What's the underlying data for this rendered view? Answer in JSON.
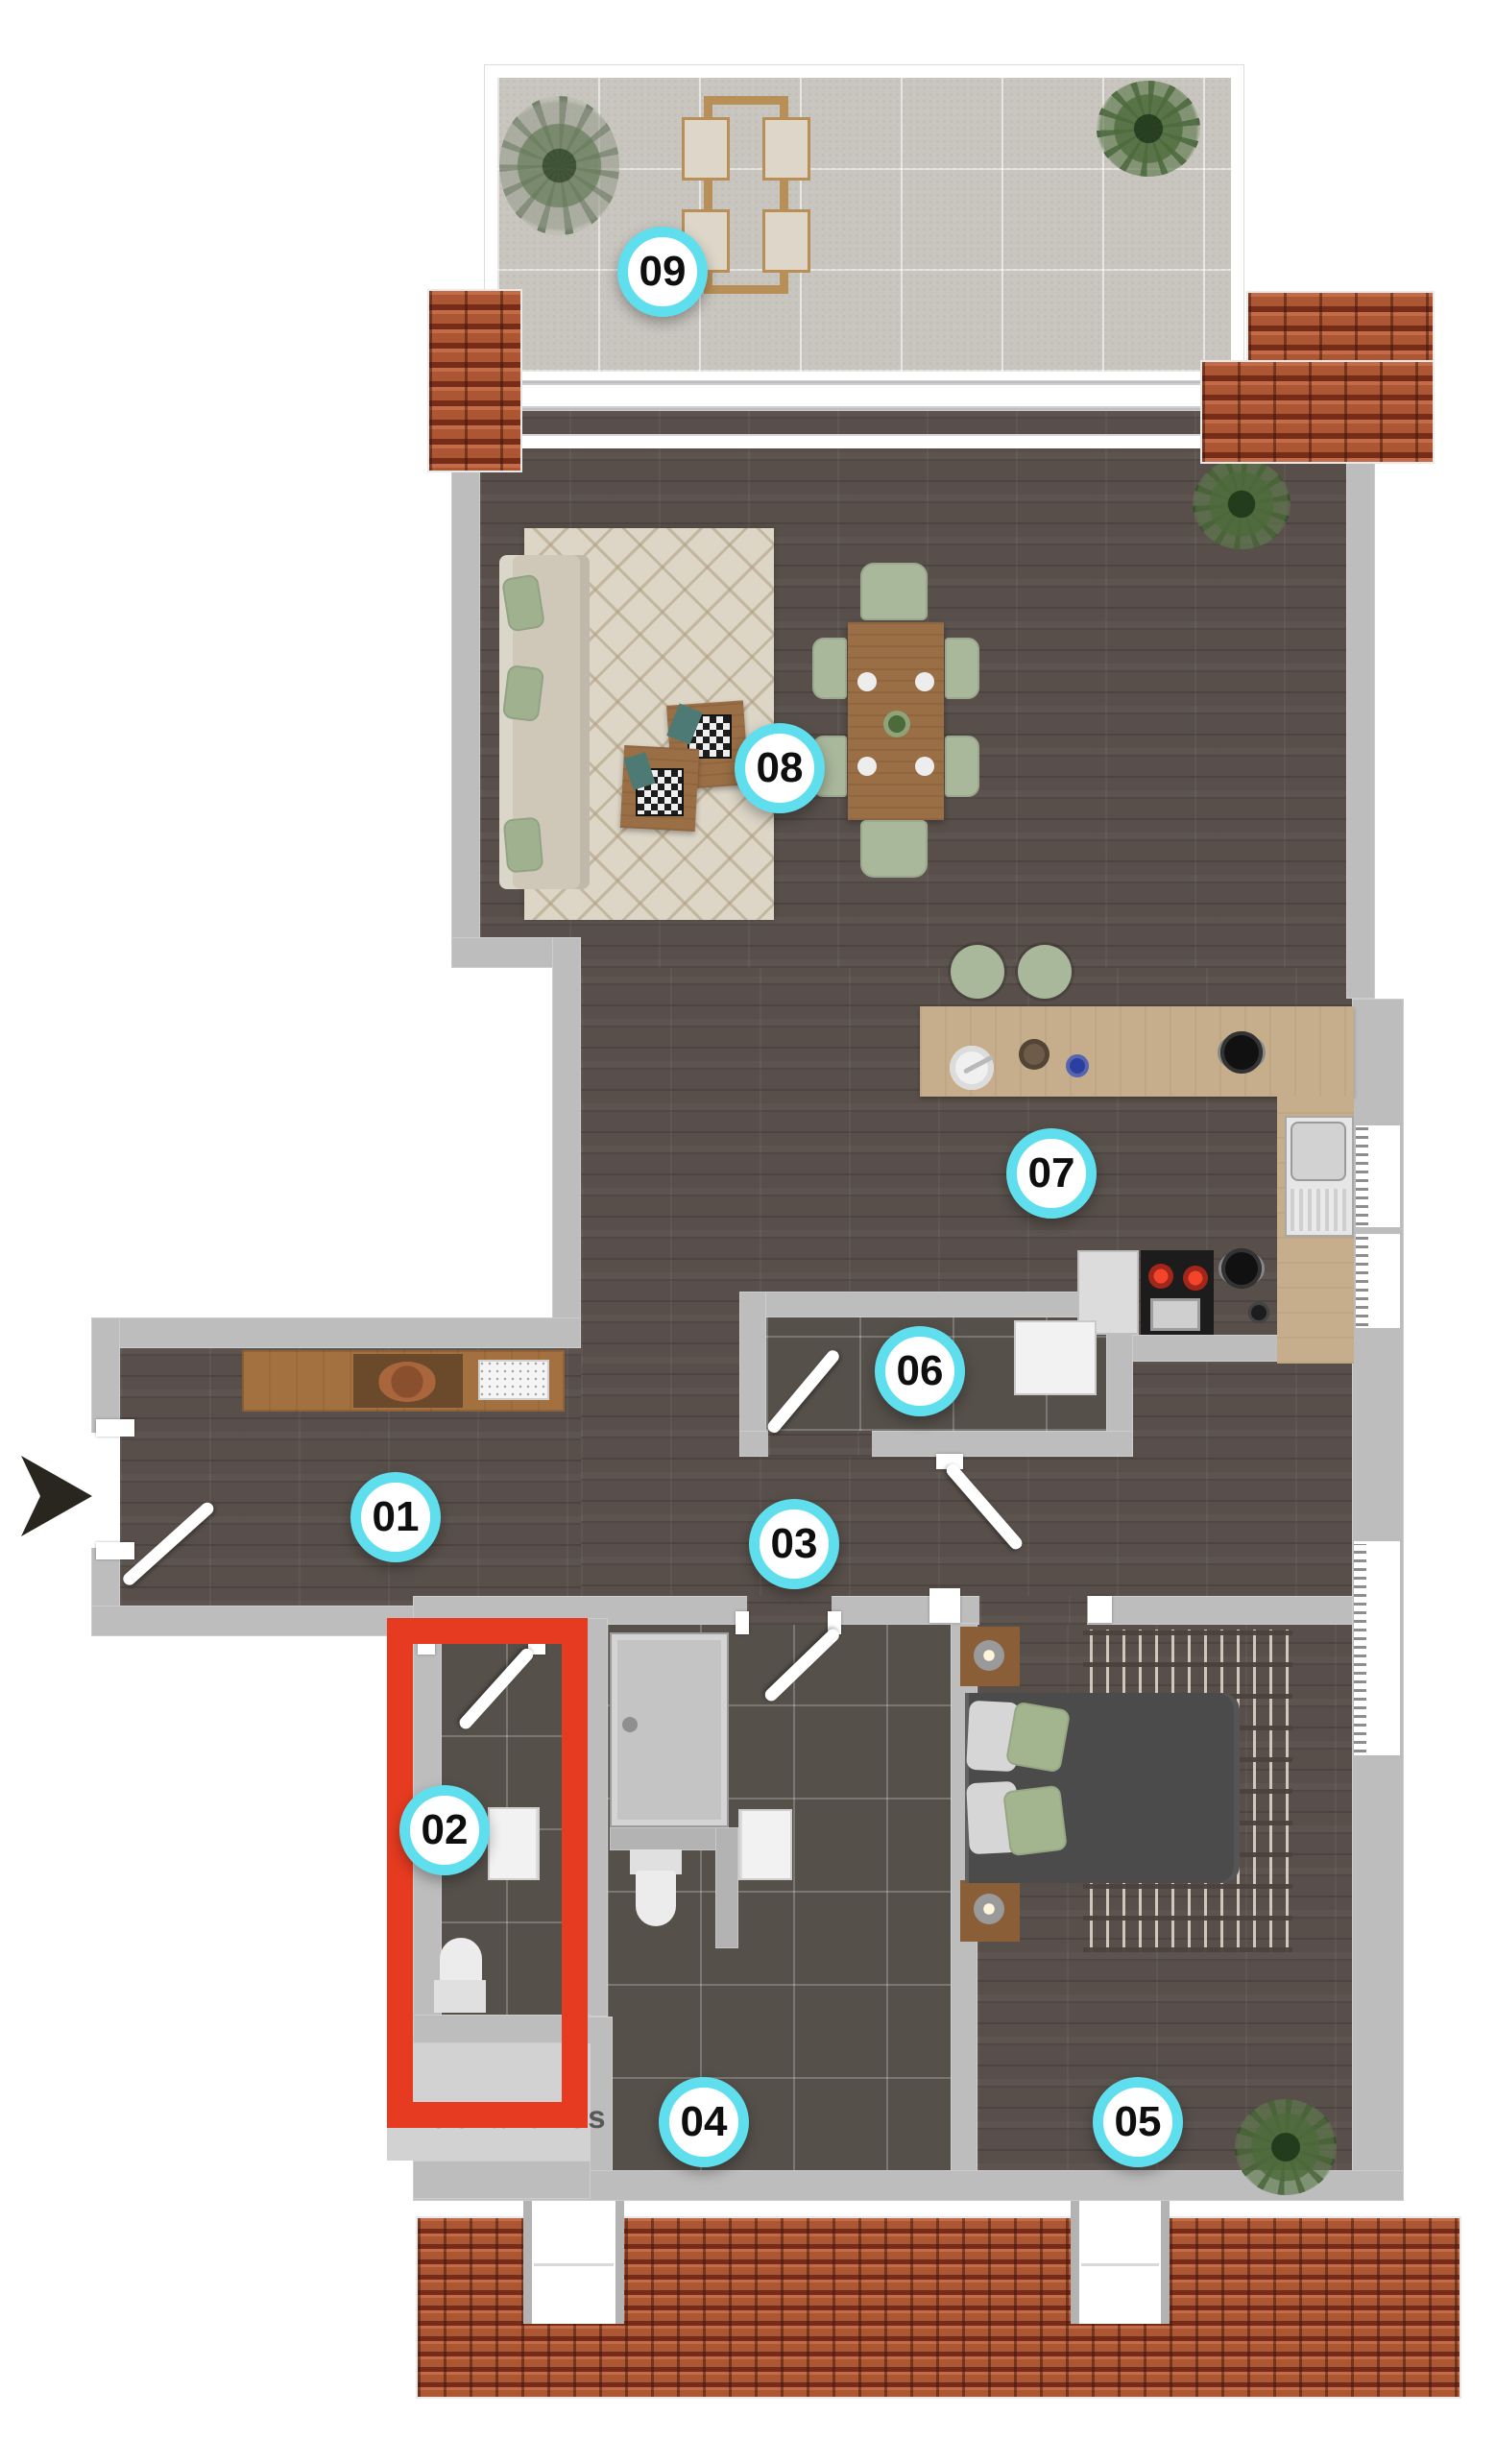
{
  "plan": {
    "title": "apartment floor plan",
    "highlighted_room": "02",
    "watermark": "MioGrandhos",
    "rooms": [
      {
        "label": "01"
      },
      {
        "label": "02"
      },
      {
        "label": "03"
      },
      {
        "label": "04"
      },
      {
        "label": "05"
      },
      {
        "label": "06"
      },
      {
        "label": "07"
      },
      {
        "label": "08"
      },
      {
        "label": "09"
      }
    ],
    "colors": {
      "highlight_red": "#E63B20",
      "badge_ring_cyan": "#5FDFEE",
      "roof_terracotta": "#A9512F",
      "floor_wood": "#584F4A",
      "floor_tile": "#55504A",
      "terrace_concrete": "#C9C6C0",
      "wall_gray": "#BDBDBD",
      "furniture_sage": "#A9B79B"
    },
    "entrance": {
      "direction": "right"
    }
  }
}
